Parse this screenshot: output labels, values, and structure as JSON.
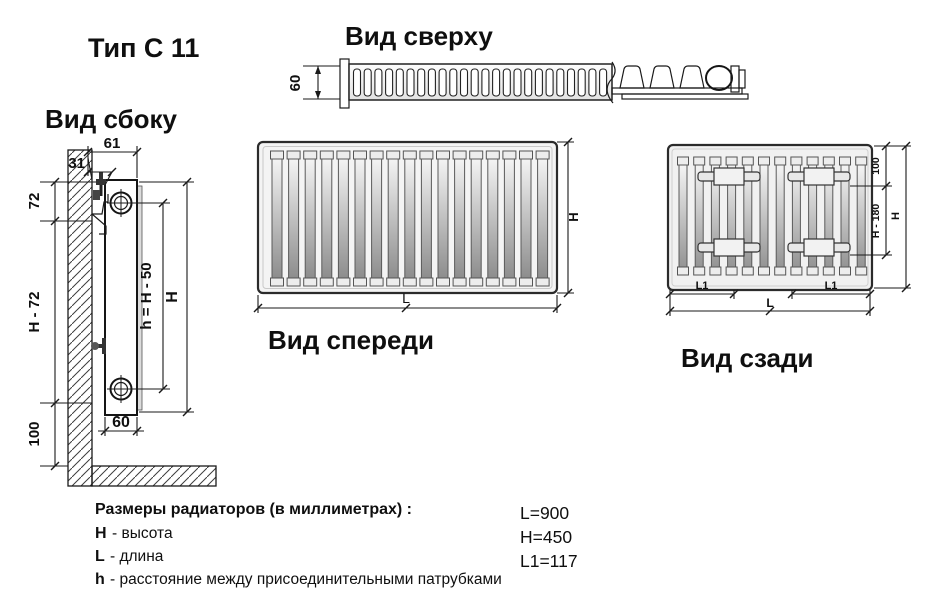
{
  "title": "Тип С 11",
  "colors": {
    "background": "#ffffff",
    "line": "#1a1a1a",
    "panel_fill": "#f2f2f2"
  },
  "views": {
    "top": {
      "label": "Вид сверху",
      "dim_depth": "60"
    },
    "side": {
      "label": "Вид сбоку",
      "dims": {
        "depth_total": "61",
        "wall_gap": "31",
        "top_offset": "72",
        "height_minus": "H - 72",
        "bottom_offset": "100",
        "pipe_spacing": "h = H - 50",
        "height": "H",
        "thickness": "60"
      }
    },
    "front": {
      "label": "Вид спереди",
      "dims": {
        "length": "L",
        "height": "H"
      }
    },
    "rear": {
      "label": "Вид сзади",
      "dims": {
        "top_bracket": "100",
        "bracket_span": "H - 180",
        "height": "H",
        "l1_left": "L1",
        "l1_right": "L1",
        "length": "L"
      }
    }
  },
  "legend": {
    "heading": "Размеры радиаторов (в миллиметрах) :",
    "items": [
      {
        "symbol": "H",
        "text": "- высота"
      },
      {
        "symbol": "L",
        "text": "- длина"
      },
      {
        "symbol": "h",
        "text": "- расстояние между присоединительными патрубками"
      }
    ]
  },
  "values": [
    {
      "text": "L=900"
    },
    {
      "text": "H=450"
    },
    {
      "text": "L1=117"
    }
  ]
}
